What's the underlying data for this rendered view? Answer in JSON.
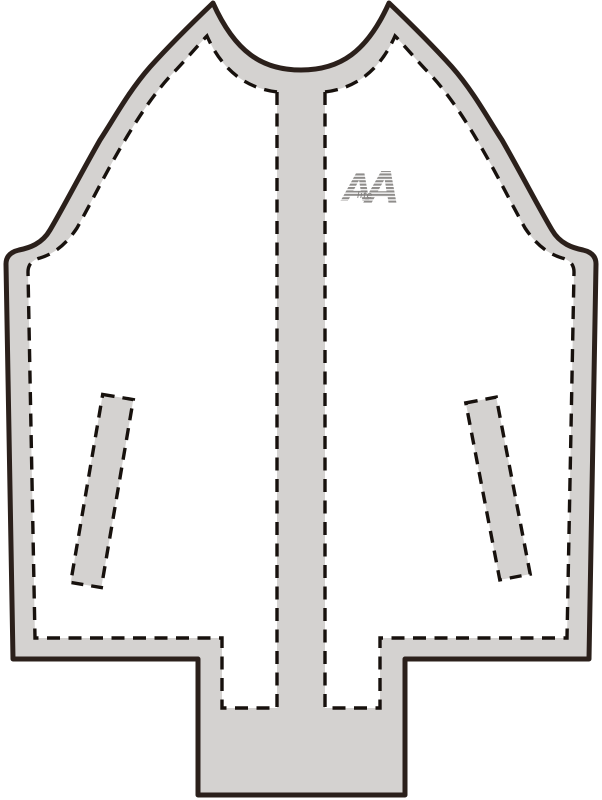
{
  "figure": {
    "title": "Jacket technical flat sketch - front view",
    "description": "Raglan-sleeve zip jacket front: grey shell outline, white front panels with dashed stitch lines, centre placket band, two slanted welt pockets, extended centre hem block",
    "colors": {
      "background": "#ffffff",
      "fabric_grey": "#d4d2d0",
      "outline_dark": "#2b201b",
      "stitch_dash": "#17110d",
      "logo_grey": "#8f8d8b"
    }
  },
  "logo": {
    "letter_left": "A",
    "letter_right": "A",
    "small_text": "life"
  },
  "paths": {
    "outer_shell": "M 213,3 C 235,52 262,70 301,70 C 340,70 367,52 389,3 C 412,25 434,47 452,67 C 474,92 490,122 502,140 C 522,175 540,210 552,230 C 560,244 573,248 583,250 Q 596,253 596,264 L 589,659 L 405,659 L 405,795 L 198,795 L 198,659 L 13,659 L 6,264 Q 6,253 19,250 C 29,248 42,244 50,230 C 62,210 80,175 100,140 C 112,122 128,92 150,67 C 168,47 190,25 213,3 Z",
    "left_panel": "M 277,92 L 277,708 L 222,708 L 222,638 L 35,638 L 28,272 Q 28,261 40,258 C 53,254 65,246 77,228 C 90,205 106,172 125,140 C 138,118 156,90 176,70 C 190,55 199,44 207,36 C 221,68 244,88 277,92 Z",
    "right_panel": "M 325,92 L 325,708 L 380,708 L 380,638 L 567,638 L 574,272 Q 574,261 562,258 C 549,254 537,246 525,228 C 512,205 496,172 477,140 C 464,118 446,90 426,70 C 412,55 403,44 395,36 C 381,68 358,88 325,92 Z",
    "left_pocket": "M 102.7,394.4 L 133.3,399.6 L 101.3,587.6 L 70.7,582.4 Z",
    "right_pocket": "M 465.8,402.9 L 496.2,397.1 L 530.2,574.1 L 499.8,579.9 Z"
  }
}
